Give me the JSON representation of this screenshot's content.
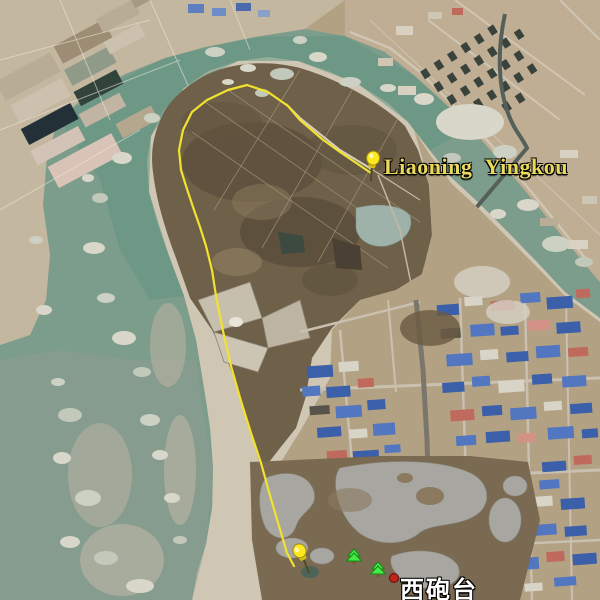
{
  "view": {
    "type": "satellite-imagery",
    "description": "Aerial view of a river oxbow bend with marsh peninsula, GPS track and industrial town"
  },
  "labels": {
    "place_pin": "Liaoning Yingkou",
    "poi": "西砲台"
  },
  "markers": {
    "pin_top": {
      "icon": "pushpin-icon",
      "color": "#ffe81e"
    },
    "pin_bottom": {
      "icon": "pushpin-icon",
      "color": "#ffe81e"
    },
    "tree_1": {
      "icon": "tree-icon",
      "color": "#46e846"
    },
    "tree_2": {
      "icon": "tree-icon",
      "color": "#46e846"
    },
    "poi_dot": {
      "icon": "poi-dot-icon",
      "color": "#c0241a"
    }
  },
  "route": {
    "color": "#f2e22e"
  },
  "colors": {
    "water": "#7c9c8c",
    "water_teal": "#5d9480",
    "ice": "#d9d6ca",
    "sand": "#cfc6b4",
    "marsh": "#6f6049",
    "farmland": "#c4b7a0",
    "urban_ground": "#b3a183",
    "roof_blue": "#3b5fa8",
    "roof_red": "#c06a5e",
    "label_yellow": "#e9d95c",
    "label_white": "#ffffff"
  }
}
